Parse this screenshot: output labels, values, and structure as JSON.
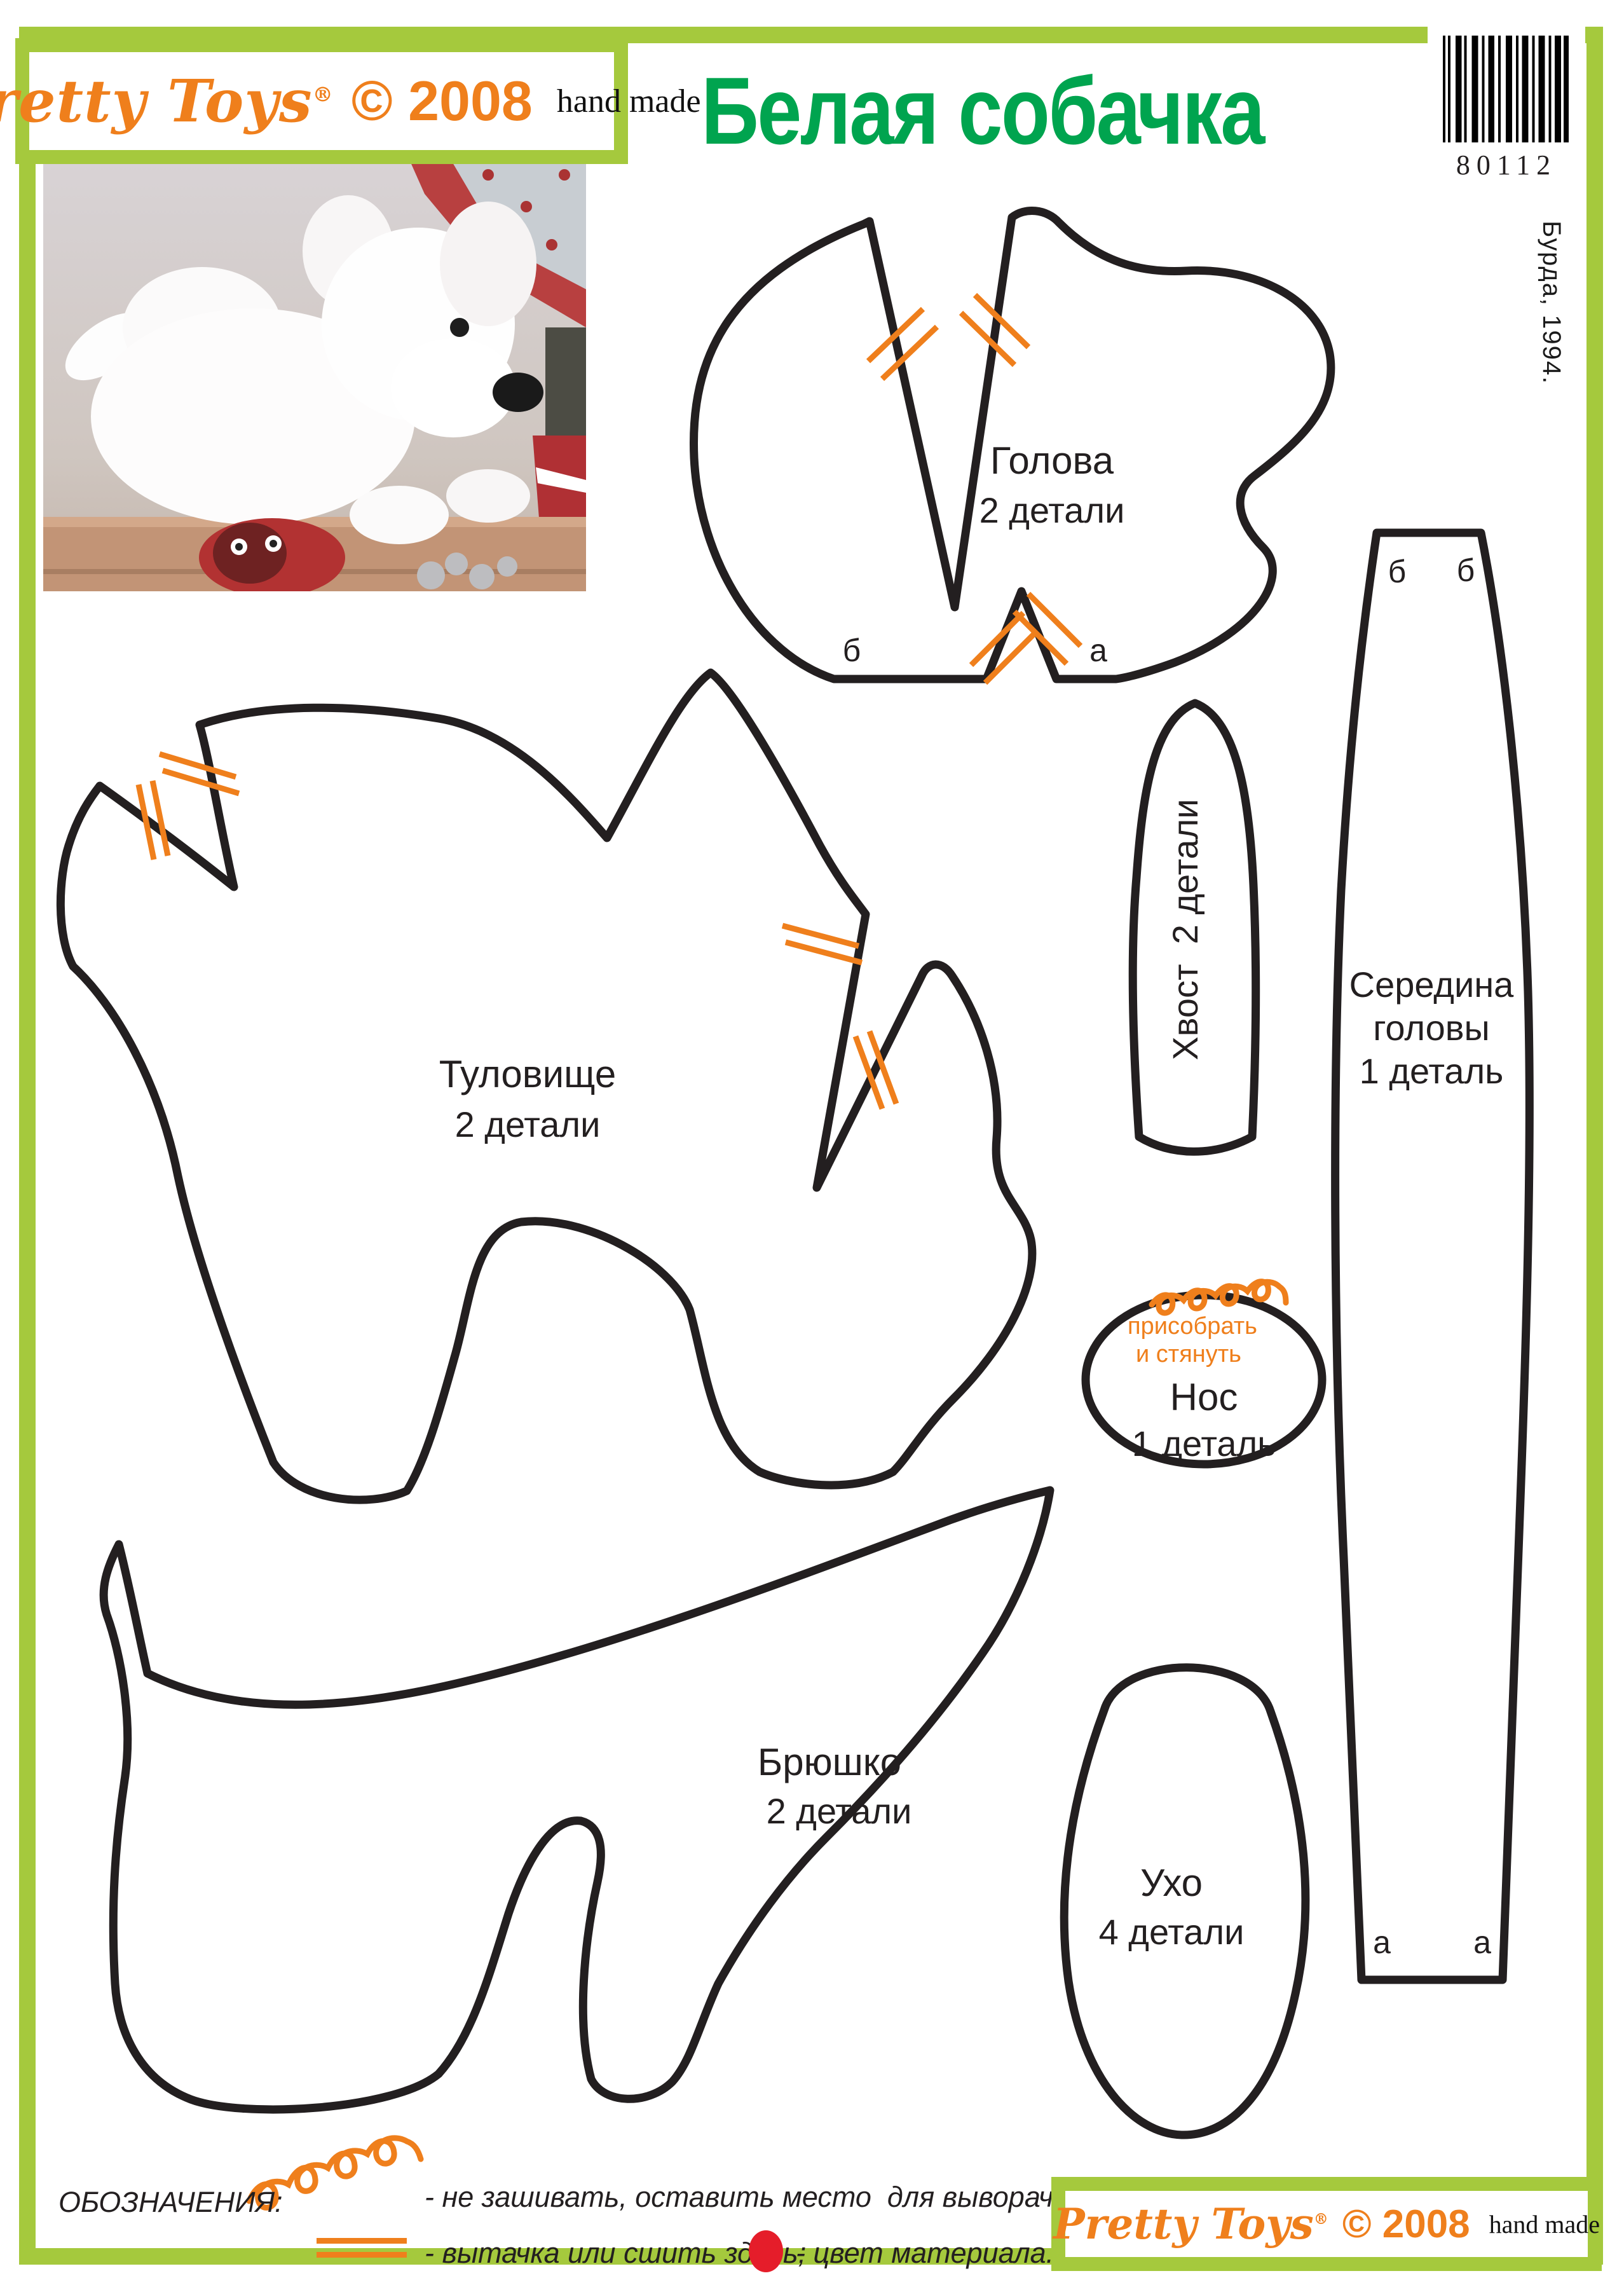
{
  "header": {
    "logo_brand": "Pretty Toys",
    "logo_reg": "®",
    "logo_year": "© 2008",
    "logo_tag": "hand made",
    "title": "Белая собачка",
    "barcode_number": "80112",
    "side_copyright": "© Бурда, 1994."
  },
  "pieces": {
    "head": {
      "name": "Голова",
      "qty": "2 детали",
      "point_b": "б",
      "point_a": "а"
    },
    "body": {
      "name": "Туловище",
      "qty": "2 детали"
    },
    "tail": {
      "name": "Хвост  2 детали"
    },
    "head_center": {
      "name_l1": "Середина",
      "name_l2": "головы",
      "name_l3": "1 деталь",
      "b1": "б",
      "b2": "б",
      "a1": "а",
      "a2": "а"
    },
    "nose": {
      "gather_l1": "присобрать",
      "gather_l2": "и стянуть",
      "name": "Нос",
      "qty": "1 деталь"
    },
    "belly": {
      "name": "Брюшко",
      "qty": "2 детали"
    },
    "ear": {
      "name": "Ухо",
      "qty": "4 детали"
    }
  },
  "legend": {
    "heading": "ОБОЗНАЧЕНИЯ:",
    "item1": "- не зашивать, оставить место  для выворачивания;",
    "item2": "- вытачка или сшить здесь;",
    "item3": "- цвет материала."
  },
  "footer": {
    "logo_brand": "Pretty Toys",
    "logo_reg": "®",
    "logo_year": "© 2008",
    "logo_tag": "hand made"
  },
  "colors": {
    "frame_green": "#a5c93d",
    "title_green": "#00a44f",
    "accent_orange": "#ef7f1c",
    "material_red": "#e51d2a",
    "outline_black": "#231f20"
  }
}
